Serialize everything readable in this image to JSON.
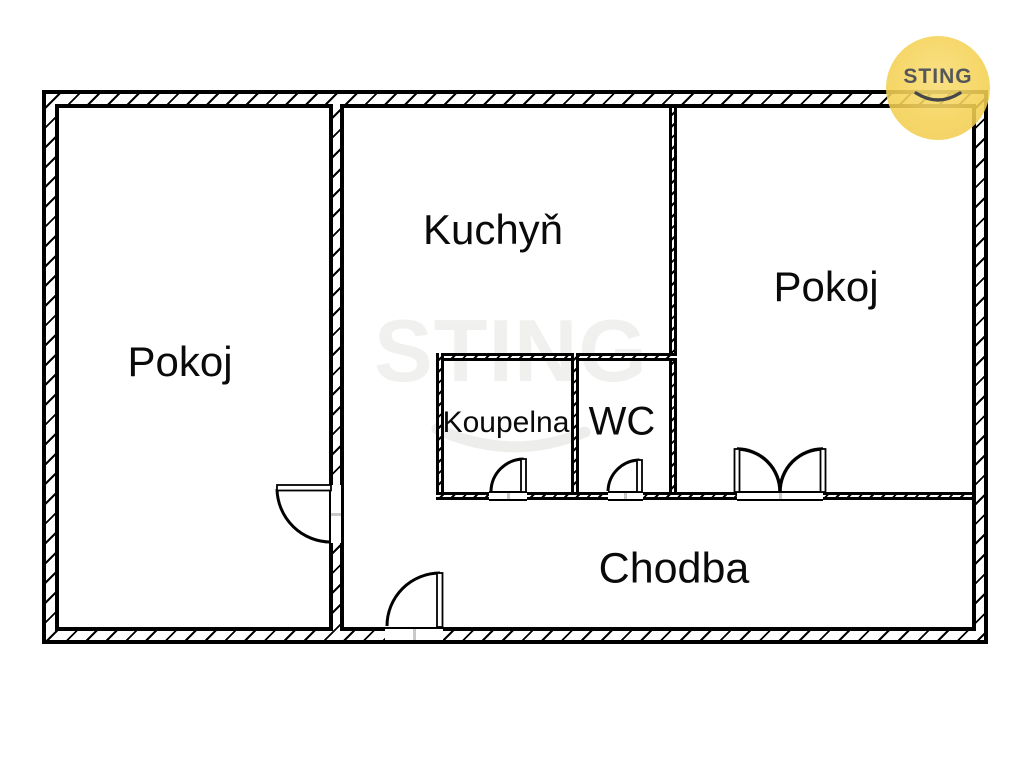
{
  "plan": {
    "rooms": [
      {
        "id": "pokoj-left",
        "label": "Pokoj"
      },
      {
        "id": "kuchyn",
        "label": "Kuchyň"
      },
      {
        "id": "pokoj-right",
        "label": "Pokoj"
      },
      {
        "id": "koupelna",
        "label": "Koupelna"
      },
      {
        "id": "wc",
        "label": "WC"
      },
      {
        "id": "chodba",
        "label": "Chodba"
      }
    ],
    "door_count": 5
  },
  "watermark": {
    "text": "STING",
    "color": "#f0f0ee"
  },
  "logo": {
    "text": "STING",
    "circle_color": "#f4d154",
    "text_color": "#55565a"
  },
  "colors": {
    "wall": "#000000",
    "background": "#ffffff",
    "threshold_tick": "#c9c9c9"
  }
}
